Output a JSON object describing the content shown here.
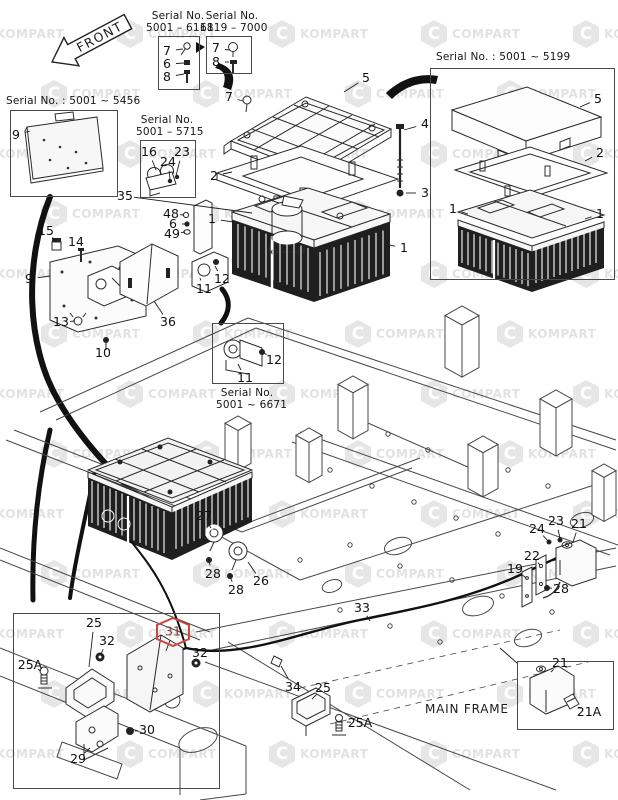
{
  "labels": {
    "front": "FRONT",
    "main_frame": "MAIN FRAME"
  },
  "watermark": {
    "texts": [
      "KOMPART",
      "COMPART"
    ],
    "color": "#e3e3e3",
    "logo_letter": "C"
  },
  "highlight": {
    "color": "#c9473c",
    "text_color": "#8a3a30",
    "part": "31"
  },
  "serial_boxes": {
    "sn6118": {
      "line1": "Serial No.",
      "line2": "5001 – 6118",
      "parts": [
        "7",
        "6",
        "8"
      ]
    },
    "sn7000": {
      "line1": "Serial No.",
      "line2": "6119 – 7000",
      "parts": [
        "7",
        "8"
      ]
    },
    "sn5456": {
      "line1": "Serial No. : 5001 ~ 5456",
      "parts": [
        "9"
      ]
    },
    "sn5715": {
      "line1": "Serial No.",
      "line2": "5001 – 5715",
      "parts": [
        "16",
        "24",
        "23"
      ]
    },
    "sn5199": {
      "line1": "Serial No. : 5001 ~ 5199",
      "parts": [
        "5",
        "2",
        "1",
        "1"
      ]
    },
    "sn6671": {
      "line1": "Serial No.",
      "line2": "5001 ~ 6671",
      "parts": [
        "11",
        "12"
      ]
    }
  },
  "callouts": [
    {
      "t": "7",
      "x": 167,
      "y": 51,
      "lx": 183,
      "ly": 49
    },
    {
      "t": "6",
      "x": 167,
      "y": 64,
      "lx": 184,
      "ly": 63
    },
    {
      "t": "8",
      "x": 167,
      "y": 77,
      "lx": 184,
      "ly": 74
    },
    {
      "t": "7",
      "x": 216,
      "y": 48,
      "lx": 229,
      "ly": 50
    },
    {
      "t": "8",
      "x": 216,
      "y": 62,
      "lx": 229,
      "ly": 62
    },
    {
      "t": "9",
      "x": 16,
      "y": 135,
      "lx": 30,
      "ly": 131
    },
    {
      "t": "16",
      "x": 149,
      "y": 152,
      "lx": 156,
      "ly": 170
    },
    {
      "t": "24",
      "x": 168,
      "y": 162,
      "lx": 170,
      "ly": 179
    },
    {
      "t": "23",
      "x": 182,
      "y": 152,
      "lx": 176,
      "ly": 176
    },
    {
      "t": "35",
      "x": 125,
      "y": 196,
      "lx": 252,
      "ly": 213
    },
    {
      "t": "5",
      "x": 366,
      "y": 78,
      "lx": 344,
      "ly": 92
    },
    {
      "t": "7",
      "x": 229,
      "y": 97,
      "lx": 243,
      "ly": 101
    },
    {
      "t": "2",
      "x": 214,
      "y": 176,
      "lx": 232,
      "ly": 172
    },
    {
      "t": "4",
      "x": 425,
      "y": 124,
      "lx": 404,
      "ly": 130
    },
    {
      "t": "3",
      "x": 425,
      "y": 193,
      "lx": 406,
      "ly": 193
    },
    {
      "t": "1",
      "x": 212,
      "y": 219,
      "lx": 234,
      "ly": 222
    },
    {
      "t": "1",
      "x": 404,
      "y": 248,
      "lx": 384,
      "ly": 244
    },
    {
      "t": "48",
      "x": 171,
      "y": 214,
      "lx": 184,
      "ly": 215
    },
    {
      "t": "6",
      "x": 173,
      "y": 224,
      "lx": 185,
      "ly": 224
    },
    {
      "t": "49",
      "x": 172,
      "y": 234,
      "lx": 185,
      "ly": 232
    },
    {
      "t": "15",
      "x": 46,
      "y": 231,
      "lx": 56,
      "ly": 241
    },
    {
      "t": "14",
      "x": 76,
      "y": 242,
      "lx": 81,
      "ly": 251
    },
    {
      "t": "9",
      "x": 29,
      "y": 279,
      "lx": 50,
      "ly": 276
    },
    {
      "t": "13",
      "x": 61,
      "y": 322,
      "lx": 75,
      "ly": 321
    },
    {
      "t": "10",
      "x": 103,
      "y": 353,
      "lx": 105,
      "ly": 344
    },
    {
      "t": "36",
      "x": 168,
      "y": 322,
      "lx": 154,
      "ly": 301
    },
    {
      "t": "11",
      "x": 204,
      "y": 289,
      "lx": 200,
      "ly": 278
    },
    {
      "t": "12",
      "x": 222,
      "y": 279,
      "lx": 215,
      "ly": 266
    },
    {
      "t": "11",
      "x": 245,
      "y": 378,
      "lx": 238,
      "ly": 364
    },
    {
      "t": "12",
      "x": 274,
      "y": 360,
      "lx": 264,
      "ly": 353
    },
    {
      "t": "5",
      "x": 598,
      "y": 99,
      "lx": 580,
      "ly": 107
    },
    {
      "t": "2",
      "x": 600,
      "y": 153,
      "lx": 585,
      "ly": 161
    },
    {
      "t": "1",
      "x": 453,
      "y": 209,
      "lx": 468,
      "ly": 214
    },
    {
      "t": "1",
      "x": 600,
      "y": 214,
      "lx": 585,
      "ly": 219
    },
    {
      "t": "27",
      "x": 204,
      "y": 516,
      "lx": 211,
      "ly": 528
    },
    {
      "t": "28",
      "x": 213,
      "y": 574,
      "lx": 209,
      "ly": 562
    },
    {
      "t": "26",
      "x": 261,
      "y": 581,
      "lx": 248,
      "ly": 562
    },
    {
      "t": "28",
      "x": 236,
      "y": 590,
      "lx": 230,
      "ly": 577
    },
    {
      "t": "33",
      "x": 362,
      "y": 608,
      "lx": 370,
      "ly": 621
    },
    {
      "t": "34",
      "x": 293,
      "y": 687,
      "lx": 281,
      "ly": 666
    },
    {
      "t": "25",
      "x": 323,
      "y": 688,
      "lx": 312,
      "ly": 699
    },
    {
      "t": "25A",
      "x": 360,
      "y": 723,
      "lx": 347,
      "ly": 722
    },
    {
      "t": "23",
      "x": 556,
      "y": 521,
      "lx": 560,
      "ly": 538
    },
    {
      "t": "21",
      "x": 579,
      "y": 524,
      "lx": 573,
      "ly": 542
    },
    {
      "t": "24",
      "x": 537,
      "y": 529,
      "lx": 548,
      "ly": 541
    },
    {
      "t": "22",
      "x": 532,
      "y": 556,
      "lx": 540,
      "ly": 565
    },
    {
      "t": "19",
      "x": 515,
      "y": 569,
      "lx": 526,
      "ly": 578
    },
    {
      "t": "28",
      "x": 561,
      "y": 589,
      "lx": 550,
      "ly": 588
    },
    {
      "t": "21",
      "x": 560,
      "y": 663,
      "lx": 551,
      "ly": 672
    },
    {
      "t": "21A",
      "x": 589,
      "y": 712,
      "lx": 578,
      "ly": 707
    },
    {
      "t": "25",
      "x": 94,
      "y": 623,
      "lx": 89,
      "ly": 667
    },
    {
      "t": "32",
      "x": 107,
      "y": 641,
      "lx": 101,
      "ly": 654
    },
    {
      "t": "31",
      "x": 173,
      "y": 632,
      "hex": true,
      "lx": 166,
      "ly": 651
    },
    {
      "t": "32",
      "x": 200,
      "y": 653,
      "lx": 196,
      "ly": 661
    },
    {
      "t": "25A",
      "x": 30,
      "y": 665,
      "lx": 41,
      "ly": 671
    },
    {
      "t": "30",
      "x": 147,
      "y": 730,
      "lx": 135,
      "ly": 731
    },
    {
      "t": "29",
      "x": 78,
      "y": 759,
      "lx": 90,
      "ly": 748
    }
  ]
}
